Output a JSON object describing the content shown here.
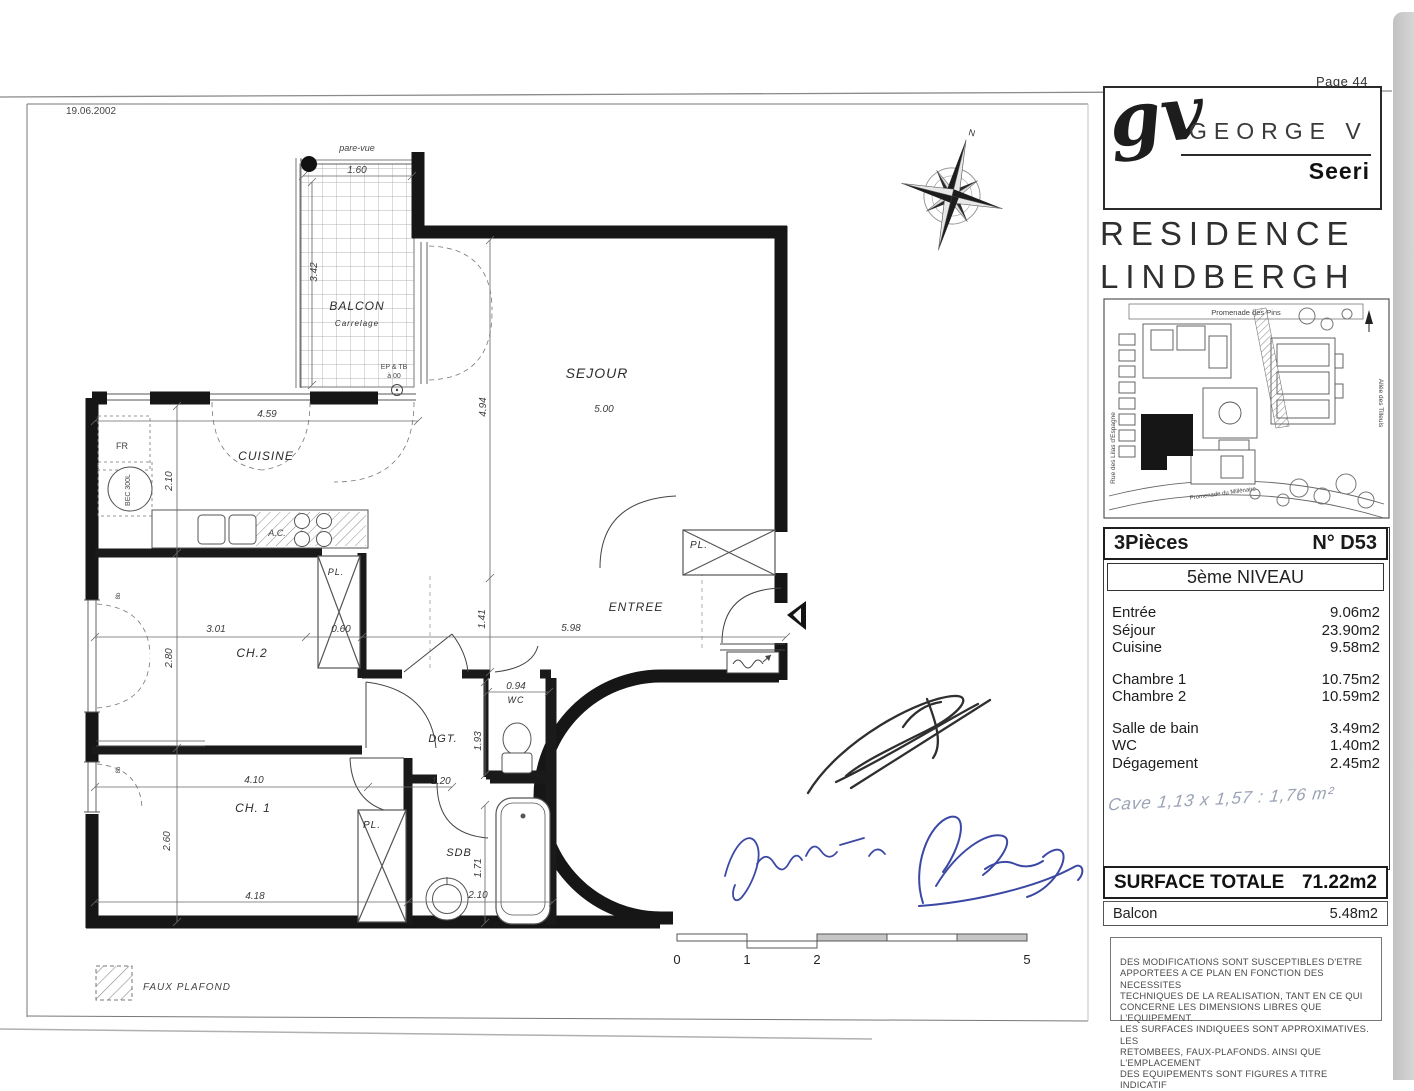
{
  "page": {
    "number_label": "Page 44"
  },
  "brand": {
    "logo_monogram": "gv",
    "logo_name": "GEORGE V",
    "logo_sub": "Seeri",
    "residence_line1": "RESIDENCE",
    "residence_line2": "LINDBERGH"
  },
  "map": {
    "street_top": "Promenade des Pins",
    "street_left": "Rue des Lilas d'Espagne",
    "street_right": "Allée des Tilleuls",
    "street_bottom": "Promenade du Millénaire"
  },
  "unit": {
    "type": "3Pièces",
    "number": "N° D53",
    "level": "5ème NIVEAU",
    "room_groups": [
      [
        {
          "label": "Entrée",
          "area": "9.06m2"
        },
        {
          "label": "Séjour",
          "area": "23.90m2"
        },
        {
          "label": "Cuisine",
          "area": "9.58m2"
        }
      ],
      [
        {
          "label": "Chambre 1",
          "area": "10.75m2"
        },
        {
          "label": "Chambre 2",
          "area": "10.59m2"
        }
      ],
      [
        {
          "label": "Salle de bain",
          "area": "3.49m2"
        },
        {
          "label": "WC",
          "area": "1.40m2"
        },
        {
          "label": "Dégagement",
          "area": "2.45m2"
        }
      ]
    ],
    "cave_note": "Cave  1,13 x 1,57 : 1,76 m²",
    "surface_total_label": "SURFACE TOTALE",
    "surface_total_value": "71.22m2",
    "balcony_label": "Balcon",
    "balcony_value": "5.48m2",
    "disclaimer_lines": [
      "DES MODIFICATIONS SONT SUSCEPTIBLES D'ETRE",
      "APPORTEES A CE PLAN EN FONCTION DES NECESSITES",
      "TECHNIQUES DE LA REALISATION, TANT EN CE QUI",
      "CONCERNE LES DIMENSIONS LIBRES QUE L'EQUIPEMENT.",
      "LES SURFACES INDIQUEES SONT APPROXIMATIVES. LES",
      "RETOMBEES, FAUX-PLAFONDS. AINSI QUE L'EMPLACEMENT",
      "DES EQUIPEMENTS SONT FIGURES A TITRE INDICATIF"
    ]
  },
  "plan": {
    "compass_n": "N",
    "rooms": [
      {
        "t": "SEJOUR",
        "x": 597,
        "y": 378,
        "s": 14
      },
      {
        "t": "CUISINE",
        "x": 266,
        "y": 460,
        "s": 12
      },
      {
        "t": "ENTREE",
        "x": 636,
        "y": 611,
        "s": 12
      },
      {
        "t": "CH.2",
        "x": 252,
        "y": 657,
        "s": 12
      },
      {
        "t": "CH. 1",
        "x": 253,
        "y": 812,
        "s": 12
      },
      {
        "t": "DGT.",
        "x": 443,
        "y": 742,
        "s": 11
      },
      {
        "t": "WC",
        "x": 516,
        "y": 703,
        "s": 9
      },
      {
        "t": "SDB",
        "x": 459,
        "y": 856,
        "s": 11
      },
      {
        "t": "BALCON",
        "x": 357,
        "y": 310,
        "s": 12
      },
      {
        "t": "Carrelage",
        "x": 357,
        "y": 326,
        "s": 8,
        "i": 1
      },
      {
        "t": "PL.",
        "x": 336,
        "y": 575,
        "s": 9
      },
      {
        "t": "PL.",
        "x": 699,
        "y": 548,
        "s": 10
      },
      {
        "t": "PL.",
        "x": 372,
        "y": 828,
        "s": 10
      }
    ],
    "dims": [
      {
        "t": "1.60",
        "x": 357,
        "y": 173
      },
      {
        "t": "3.42",
        "x": 317,
        "y": 272,
        "r": -90
      },
      {
        "t": "4.59",
        "x": 267,
        "y": 417
      },
      {
        "t": "2.10",
        "x": 172,
        "y": 481,
        "r": -90
      },
      {
        "t": "5.00",
        "x": 604,
        "y": 412
      },
      {
        "t": "4.94",
        "x": 486,
        "y": 407,
        "r": -90
      },
      {
        "t": "3.01",
        "x": 216,
        "y": 632
      },
      {
        "t": "0.60",
        "x": 341,
        "y": 632
      },
      {
        "t": "5.98",
        "x": 571,
        "y": 631
      },
      {
        "t": "1.41",
        "x": 485,
        "y": 619,
        "r": -90
      },
      {
        "t": "2.80",
        "x": 172,
        "y": 658,
        "r": -90
      },
      {
        "t": "0.94",
        "x": 516,
        "y": 689
      },
      {
        "t": "1.93",
        "x": 481,
        "y": 741,
        "r": -90
      },
      {
        "t": "1.20",
        "x": 441,
        "y": 784
      },
      {
        "t": "4.10",
        "x": 254,
        "y": 783
      },
      {
        "t": "2.60",
        "x": 170,
        "y": 841,
        "r": -90
      },
      {
        "t": "1.71",
        "x": 481,
        "y": 868,
        "r": -90
      },
      {
        "t": "2.10",
        "x": 478,
        "y": 898
      },
      {
        "t": "4.18",
        "x": 255,
        "y": 899
      }
    ],
    "annotations": [
      {
        "t": "pare-vue",
        "x": 357,
        "y": 151,
        "s": 9,
        "i": 1
      },
      {
        "t": "FR",
        "x": 122,
        "y": 449,
        "s": 9
      },
      {
        "t": "BEC 300L",
        "x": 130,
        "y": 490,
        "s": 7,
        "r": -90
      },
      {
        "t": "A.C.",
        "x": 277,
        "y": 536,
        "s": 9,
        "i": 1
      },
      {
        "t": "EP & TB",
        "x": 394,
        "y": 369,
        "s": 7
      },
      {
        "t": "à 00",
        "x": 394,
        "y": 378,
        "s": 7
      },
      {
        "t": "8b",
        "x": 120,
        "y": 596,
        "s": 6,
        "r": -90
      },
      {
        "t": "8b",
        "x": 120,
        "y": 770,
        "s": 6,
        "r": -90
      },
      {
        "t": "19.06.2002",
        "x": 66,
        "y": 114,
        "s": 10,
        "a": "start",
        "c": "#555"
      },
      {
        "t": "FAUX PLAFOND",
        "x": 143,
        "y": 990,
        "s": 10,
        "a": "start",
        "ls": 1,
        "i": 1
      }
    ],
    "scale_labels": [
      {
        "t": "0",
        "x": 677,
        "y": 964
      },
      {
        "t": "1",
        "x": 747,
        "y": 964
      },
      {
        "t": "2",
        "x": 817,
        "y": 964
      },
      {
        "t": "5",
        "x": 1027,
        "y": 964
      }
    ]
  }
}
